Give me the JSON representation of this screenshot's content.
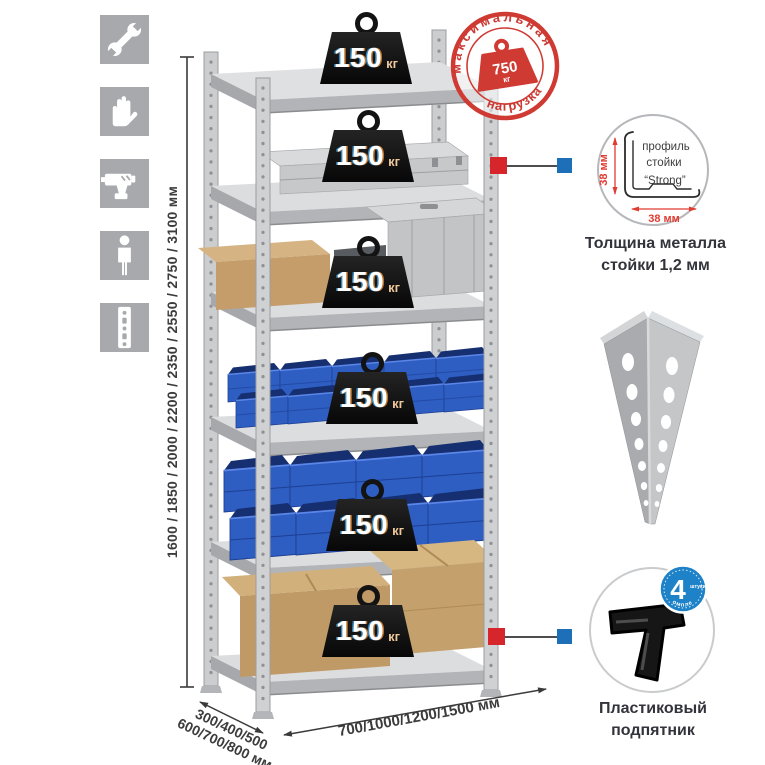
{
  "colors": {
    "stamp_red": "#cc3a34",
    "marker_red": "#d6252b",
    "marker_blue": "#1d6fb8",
    "badge_blue": "#1e82c8",
    "bin_blue": "#2e5ec2",
    "metal_gray": "#c9cbcd",
    "icon_gray": "#a7a9ac",
    "dim_red": "#e23b31"
  },
  "left_icons": [
    {
      "name": "wrench"
    },
    {
      "name": "gloves"
    },
    {
      "name": "drill"
    },
    {
      "name": "person"
    },
    {
      "name": "rack-post"
    }
  ],
  "height_dim": {
    "label": "1600 / 1850 / 2000 / 2200 / 2350 / 2550 / 2750 / 3100 мм"
  },
  "stamp": {
    "arc_top": "максимальная",
    "arc_bottom": "нагрузка",
    "value": "750",
    "unit": "кг"
  },
  "shelves": [
    {
      "load": "150",
      "unit": "кг"
    },
    {
      "load": "150",
      "unit": "кг"
    },
    {
      "load": "150",
      "unit": "кг"
    },
    {
      "load": "150",
      "unit": "кг"
    },
    {
      "load": "150",
      "unit": "кг"
    },
    {
      "load": "150",
      "unit": "кг"
    }
  ],
  "profile_detail": {
    "text_line1": "профиль",
    "text_line2": "стойки",
    "text_line3": "“Strong”",
    "dim_vertical": "38 мм",
    "dim_horizontal": "38 мм",
    "caption_line1": "Толщина металла",
    "caption_line2": "стойки 1,2 мм"
  },
  "foot_detail": {
    "badge_number": "4",
    "badge_word": "штуки",
    "badge_arc": "в комплекте",
    "caption_line1": "Пластиковый",
    "caption_line2": "подпятник"
  },
  "width_dim": {
    "label": "700/1000/1200/1500 мм"
  },
  "depth_dim": {
    "line1": "300/400/500",
    "line2": "600/700/800 мм"
  }
}
